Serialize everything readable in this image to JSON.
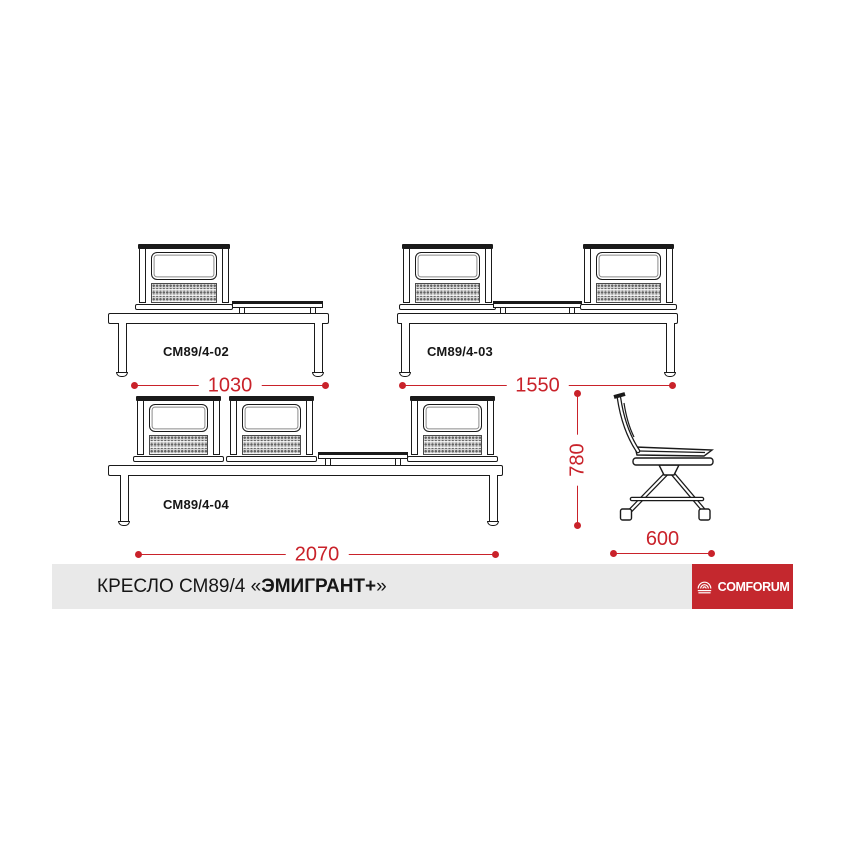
{
  "colors": {
    "dimension_red": "#c9222a",
    "logo_red": "#c4282e",
    "line_color": "#1a1a1a",
    "footer_bar_bg": "#e9e9e9"
  },
  "drawings": [
    {
      "model": "СМ89/4-02",
      "width_mm": "1030",
      "description": "one seat with table, front view"
    },
    {
      "model": "СМ89/4-03",
      "width_mm": "1550",
      "description": "two seats with center table, front view"
    },
    {
      "model": "СМ89/4-04",
      "width_mm": "2070",
      "description": "three seats with table, front view"
    }
  ],
  "side_view": {
    "height_mm": "780",
    "depth_mm": "600"
  },
  "footer": {
    "title_prefix": "КРЕСЛО СМ89/4 «",
    "title_bold": "ЭМИГРАНТ+",
    "title_suffix": "»",
    "brand": "COMFORUM"
  }
}
